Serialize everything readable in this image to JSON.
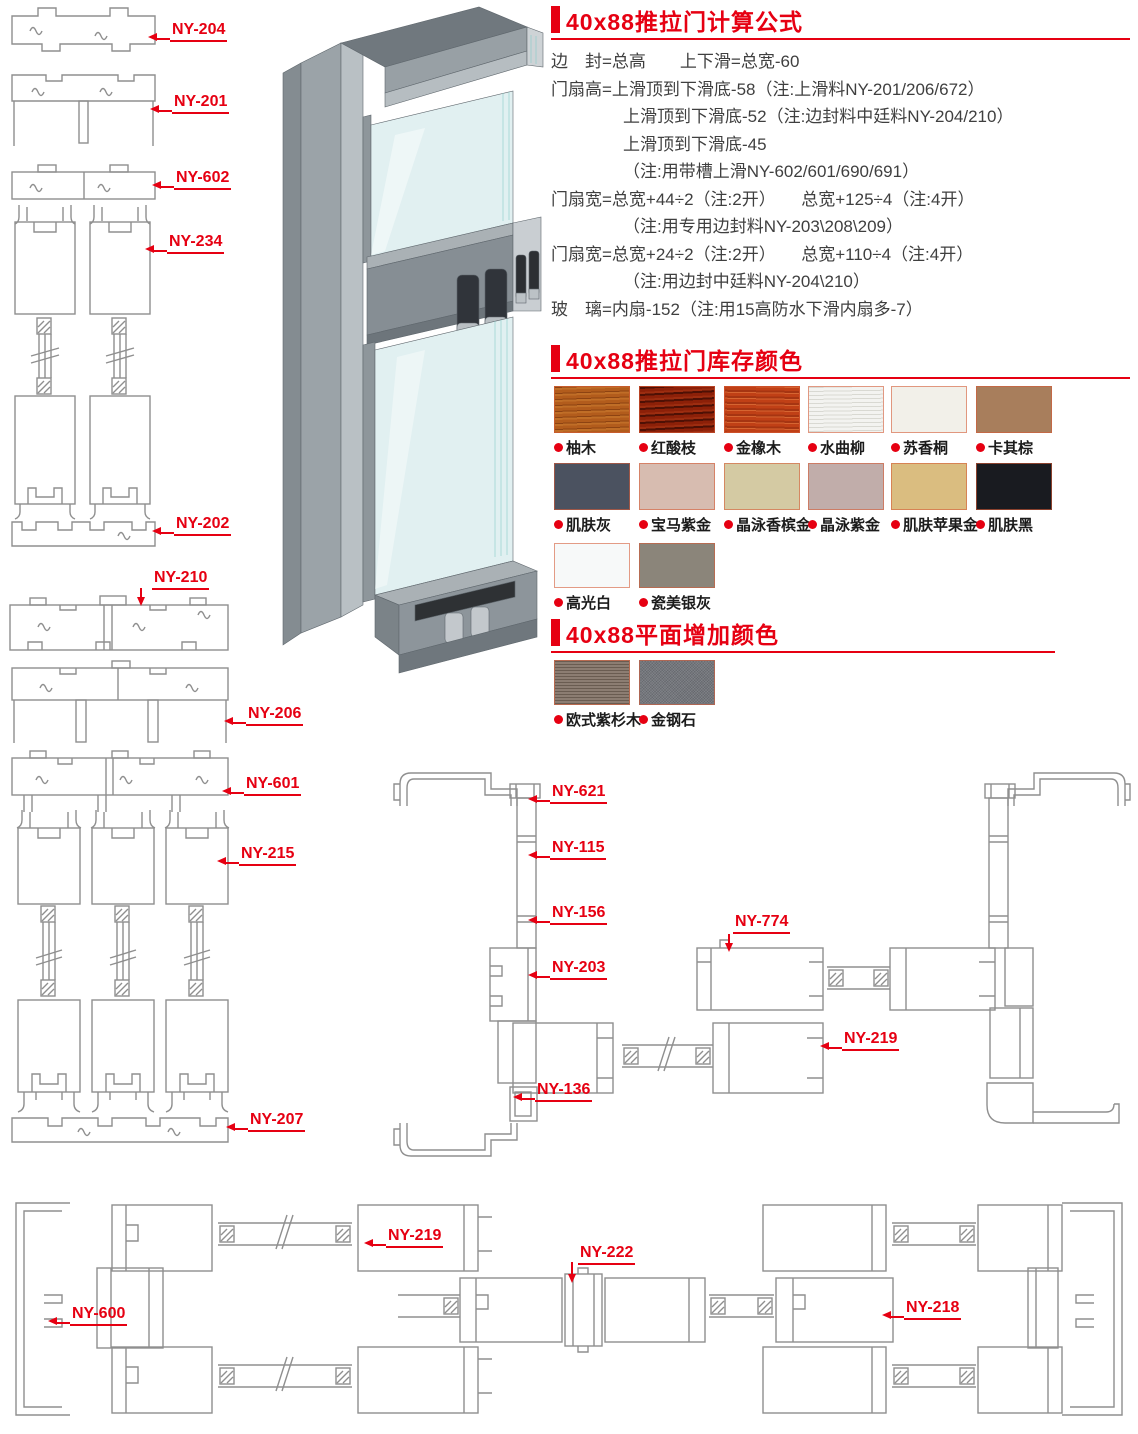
{
  "page": {
    "accent": "#e60012",
    "line_color": "#8f8f8f"
  },
  "callouts": [
    "NY-204",
    "NY-201",
    "NY-602",
    "NY-234",
    "NY-202",
    "NY-210",
    "NY-206",
    "NY-601",
    "NY-215",
    "NY-207",
    "NY-621",
    "NY-115",
    "NY-156",
    "NY-203",
    "NY-774",
    "NY-219",
    "NY-136",
    "NY-219",
    "NY-222",
    "NY-218",
    "NY-600"
  ],
  "formula": {
    "title": "40x88推拉门计算公式",
    "lines": [
      "边　封=总高　　上下滑=总宽-60",
      "门扇高=上滑顶到下滑底-58（注:上滑料NY-201/206/672）",
      "上滑顶到下滑底-52（注:边封料中廷料NY-204/210）",
      "上滑顶到下滑底-45",
      "（注:用带槽上滑NY-602/601/690/691）",
      "门扇宽=总宽+44÷2（注:2开）　　总宽+125÷4（注:4开）",
      "（注:用专用边封料NY-203\\208\\209）",
      "门扇宽=总宽+24÷2（注:2开）　　总宽+110÷4（注:4开）",
      "（注:用边封中廷料NY-204\\210）",
      "玻　璃=内扇-152（注:用15高防水下滑内扇多-7）"
    ]
  },
  "stock_colors": {
    "title": "40x88推拉门库存颜色",
    "swatches": [
      {
        "name": "柚木",
        "hex": "#b25c1c"
      },
      {
        "name": "红酸枝",
        "hex": "#8c2008"
      },
      {
        "name": "金橡木",
        "hex": "#c04016"
      },
      {
        "name": "水曲柳",
        "hex": "#f3f3f0"
      },
      {
        "name": "苏香桐",
        "hex": "#f2f0e9"
      },
      {
        "name": "卡其棕",
        "hex": "#a87e5c"
      },
      {
        "name": "肌肤灰",
        "hex": "#4b5260"
      },
      {
        "name": "宝马紫金",
        "hex": "#d7bcb0"
      },
      {
        "name": "晶泳香槟金",
        "hex": "#d4caa3"
      },
      {
        "name": "晶泳紫金",
        "hex": "#c1adaa"
      },
      {
        "name": "肌肤苹果金",
        "hex": "#dabd80"
      },
      {
        "name": "肌肤黑",
        "hex": "#191b20"
      },
      {
        "name": "高光白",
        "hex": "#f7f9f9"
      },
      {
        "name": "瓷美银灰",
        "hex": "#8b857a"
      }
    ]
  },
  "added_colors": {
    "title": "40x88平面增加颜色",
    "swatches": [
      {
        "name": "欧式紫杉木",
        "hex": "#8c7d72"
      },
      {
        "name": "金钢石",
        "hex": "#74777d"
      }
    ]
  }
}
